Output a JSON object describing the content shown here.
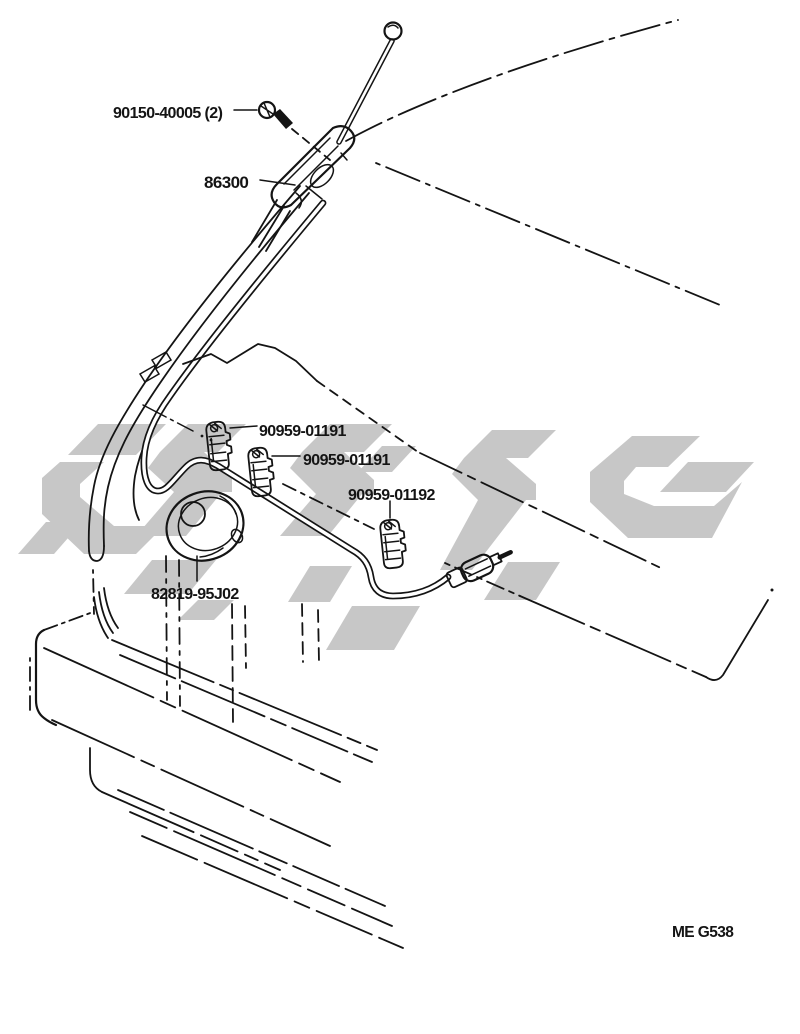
{
  "diagram": {
    "labels": {
      "screw": "90150-40005 (2)",
      "antenna": "86300",
      "clamp_a": "90959-01191",
      "clamp_b": "90959-01191",
      "clamp_c": "90959-01192",
      "grommet": "82819-95J02"
    },
    "figure_code": "ME G538",
    "colors": {
      "line": "#141414",
      "watermark": "#c7c7c7",
      "background": "#ffffff"
    }
  }
}
